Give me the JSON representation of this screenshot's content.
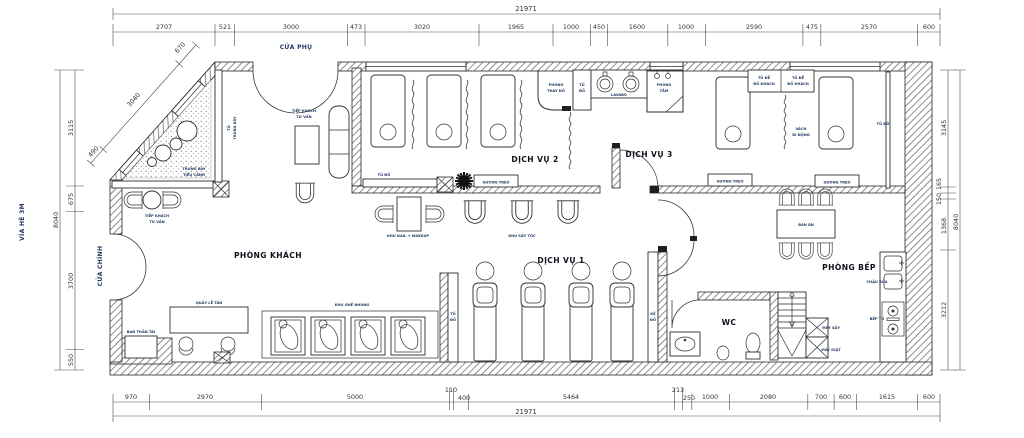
{
  "plan": {
    "sidewalk_label": "VỈA HÈ 3M",
    "doors": {
      "side_door": "CỬA PHỤ",
      "main_door": "CỬA CHÍNH"
    },
    "rooms": {
      "lobby": "PHÒNG KHÁCH",
      "service1": "DỊCH VỤ 1",
      "service2": "DỊCH VỤ 2",
      "service3": "DỊCH VỤ 3",
      "kitchen": "PHÒNG BẾP",
      "wc": "WC",
      "bathroom_l1": "PHÒNG",
      "bathroom_l2": "TẮM",
      "changing_l1": "PHÒNG",
      "changing_l2": "THAY ĐỒ"
    },
    "furniture": {
      "reception_seating_l1": "TIẾP KHÁCH",
      "reception_seating_l2": "TƯ VẤN",
      "display_cabinet_l1": "TỦ",
      "display_cabinet_l2": "TRUNG BÀY",
      "garden_l1": "TRƯNG BÀY",
      "garden_l2": "TIỂU CẢNH",
      "reception_desk": "QUẦY LỄ TÂN",
      "altar": "BAN THẦN TÀI",
      "velvet_chairs": "KHU GHẾ NHUNG",
      "nail_area": "KHU NAIL + MAKEUP",
      "hair_dry_area": "KHU SẤY TÓC",
      "locker": "TỦ ĐỒ",
      "locker_l1": "TỦ",
      "locker_l2": "ĐỒ",
      "shelf_l1": "KỆ",
      "shelf_l2": "ĐỒ",
      "lavabo": "LAVABO",
      "guest_cab_l1": "TỦ ĐỂ",
      "guest_cab_l2": "ĐỒ KHÁCH",
      "partition_l1": "VÁCH",
      "partition_l2": "DI ĐỘNG",
      "mirror": "GƯƠNG TREO",
      "dining_table": "BÀN ĂN",
      "kitchen_sink": "CHẬU RỬA",
      "stove": "BẾP TỪ",
      "dryer": "MÁY SẤY",
      "washer": "MÁY GIẶT"
    },
    "dimensions": {
      "total": "21971",
      "top": [
        "2707",
        "521",
        "3000",
        "473",
        "3020",
        "1965",
        "1000",
        "450",
        "1600",
        "1000",
        "2590",
        "475",
        "2570",
        "600"
      ],
      "bottom": [
        "970",
        "2970",
        "5000",
        "110",
        "400",
        "5464",
        "213",
        "250",
        "1000",
        "2080",
        "700",
        "600",
        "1615",
        "600"
      ],
      "left": [
        "3115",
        "675",
        "3700",
        "550"
      ],
      "left_total": "8040",
      "right": [
        "3145",
        "165",
        "150",
        "1368",
        "3212"
      ],
      "right_total": "8040",
      "diagonal": [
        "670",
        "3040",
        "490"
      ]
    }
  }
}
